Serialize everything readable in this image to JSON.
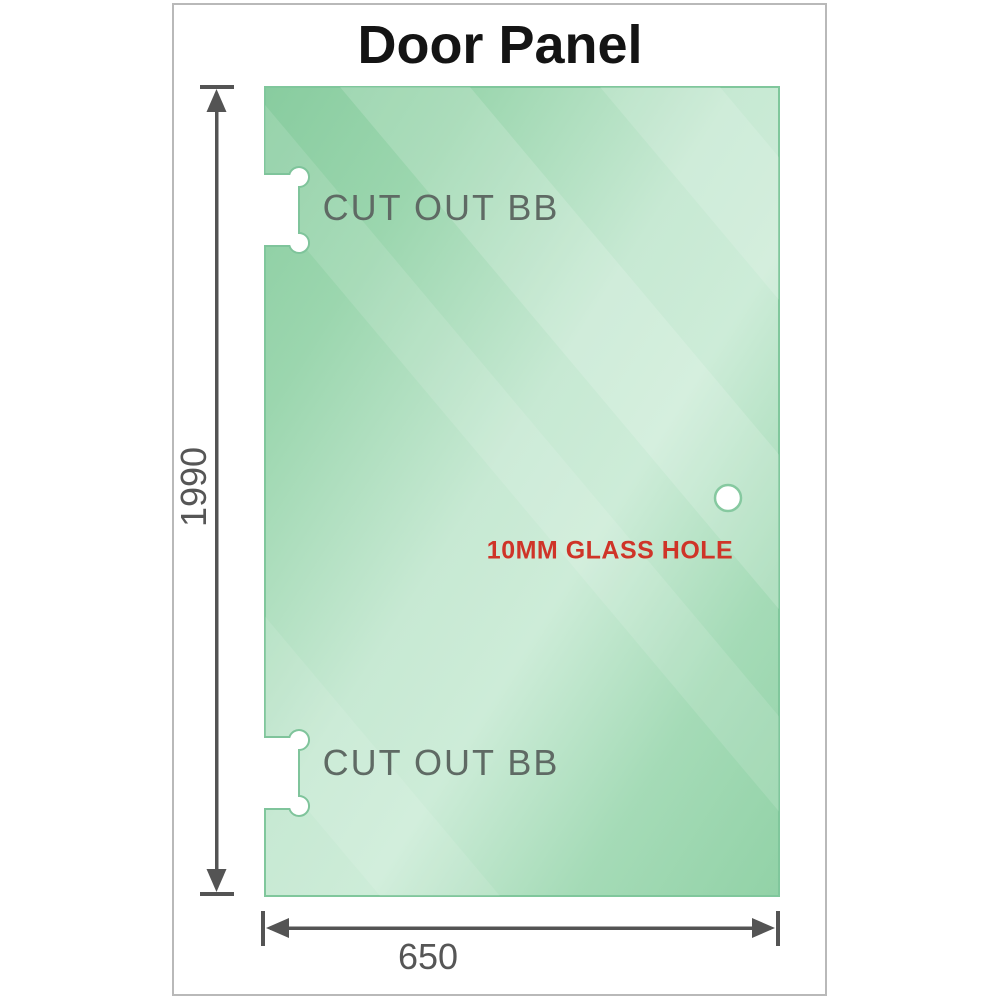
{
  "title": "Door Panel",
  "labels": {
    "cutout_top": "CUT OUT BB",
    "cutout_bottom": "CUT OUT BB",
    "glass_hole": "10MM GLASS HOLE"
  },
  "dimensions": {
    "height_mm": "1990",
    "width_mm": "650"
  },
  "colors": {
    "glass_green_dark": "#88cc9f",
    "glass_green_mid": "#a5dbb7",
    "glass_green_light": "#cdecd8",
    "panel_edge": "#80c79c",
    "dimension_lines": "#545454",
    "cutout_label_gray": "#5f6a64",
    "glass_hole_label_red": "#cf3428",
    "frame_border": "#b9b9b9",
    "title_text": "#141414"
  }
}
